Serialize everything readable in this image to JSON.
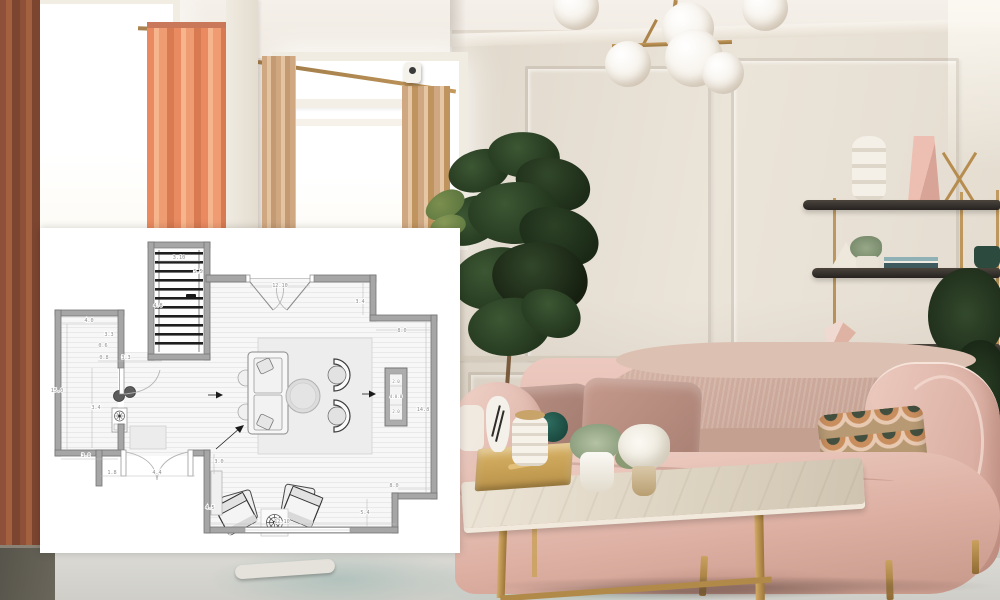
{
  "scene": {
    "type": "living-room-photo-with-floorplan-overlay",
    "objects": [
      "window-left",
      "window-right",
      "rust-curtain",
      "salmon-curtain",
      "tan-curtains",
      "curtain-rods",
      "security-camera",
      "brass-globe-chandelier",
      "fiddle-leaf-plant",
      "paneled-wall",
      "brass-shelving-unit",
      "ring-vase",
      "pink-geometric-vase",
      "white-triangle-sculpture",
      "books",
      "green-plant-pots",
      "pink-velvet-sofa",
      "fur-throw",
      "velvet-pillows",
      "patterned-pillow",
      "marble-coffee-table",
      "gold-tray",
      "black-and-white-vase",
      "ribbed-canister",
      "teal-sphere",
      "air-plant",
      "white-flowers",
      "area-rug"
    ],
    "colors": {
      "wall_left": "#ddd5ca",
      "wall_right": "#e9e2d7",
      "ceiling": "#f4efe9",
      "curtain_rust": "#8e5038",
      "curtain_salmon": "#ef9c72",
      "curtain_tan": "#cfa881",
      "brass": "#b98e52",
      "plant_green": "#22351d",
      "shelf_dark": "#2f2b27",
      "sofa_blush": "#e5c0b5",
      "pillow_mauve": "#a97f75",
      "marble": "#e6ddcf",
      "rug": "#d9d8d4",
      "plan_background": "#ffffff",
      "plan_wall_gray": "#a6a6a6"
    }
  },
  "floor_plan": {
    "dims": {
      "stairs_width": "3.10",
      "stairs_side": "5.5",
      "stairs_left": "4.8",
      "closet_width_top": "4.0",
      "closet_upper_right": "3.3",
      "closet_small": "0.6",
      "closet_door_offset": "0.8",
      "closet_door_width": "3.3",
      "closet_height": "15.0",
      "closet_mid": "3.4",
      "closet_width_bottom": "3.0",
      "lower_door_offset": "1.8",
      "lower_door_width": "4.4",
      "top_door_width": "12.10",
      "top_right_step": "3.4",
      "top_right_width": "8.0",
      "console_top": "2.0",
      "console_mid": "4.0.0",
      "console_bottom": "2.0",
      "right_height": "14.8",
      "bottom_right_width": "8.0",
      "bottom_right_step": "5.4",
      "bottom_window_width": "12.10",
      "lower_left_wall": "3.0",
      "lower_console": "4.5"
    }
  }
}
